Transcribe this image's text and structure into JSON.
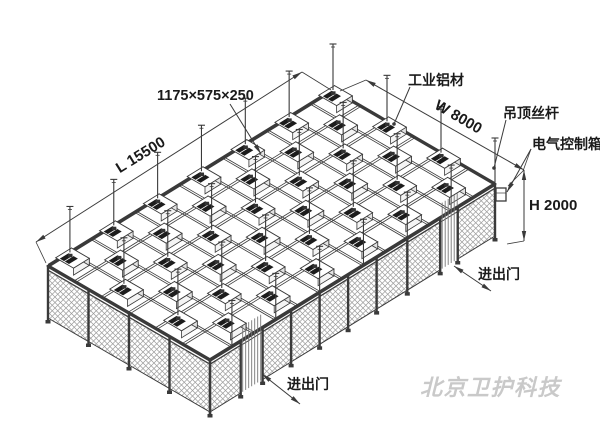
{
  "diagram": {
    "dimensions": {
      "ffu_size": "1175×575×250",
      "length": "L 15500",
      "width": "W 8000",
      "height": "H 2000"
    },
    "callouts": {
      "material": "工业铝材",
      "ceiling_rod": "吊顶丝杆",
      "control_box": "电气控制箱",
      "door_right": "进出门",
      "door_bottom": "进出门"
    },
    "watermark": "北京卫护科技",
    "colors": {
      "line": "#3a3a3a",
      "text": "#1a1a1a",
      "mesh": "#9a9a9a",
      "strip": "#777777",
      "ffu_grille": "#1c1c1c",
      "watermark": "#c9c9c9",
      "background": "#ffffff"
    }
  }
}
